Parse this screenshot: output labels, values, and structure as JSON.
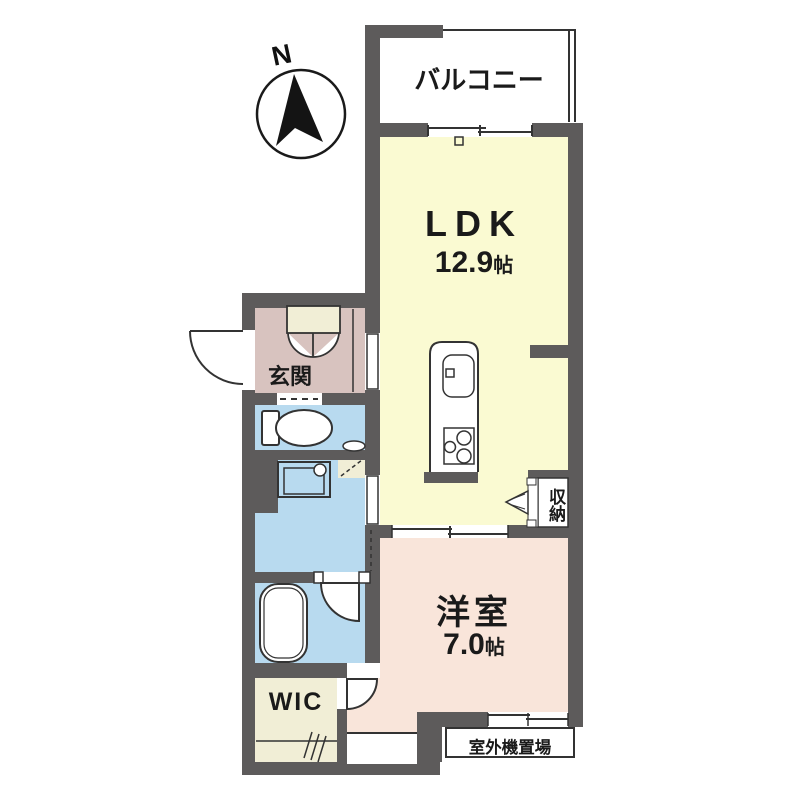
{
  "compass": {
    "north_label": "N"
  },
  "rooms": {
    "balcony": {
      "label": "バルコニー"
    },
    "ldk": {
      "label": "LDK",
      "size_value": "12.9",
      "size_unit": "帖"
    },
    "entrance": {
      "label": "玄関"
    },
    "storage": {
      "label": "収納"
    },
    "western_room": {
      "label": "洋室",
      "size_value": "7.0",
      "size_unit": "帖"
    },
    "walk_in_closet": {
      "label": "WIC"
    },
    "outdoor_unit": {
      "label": "室外機置場"
    }
  },
  "colors": {
    "wall": "#5d5b5b",
    "line": "#333333",
    "ldk_floor": "#fafad2",
    "western_room_floor": "#f9e5da",
    "entrance_floor": "#d8c3bf",
    "wet_area_floor": "#b8daef",
    "closet_floor": "#f1eed6",
    "balcony_floor": "#ffffff"
  }
}
